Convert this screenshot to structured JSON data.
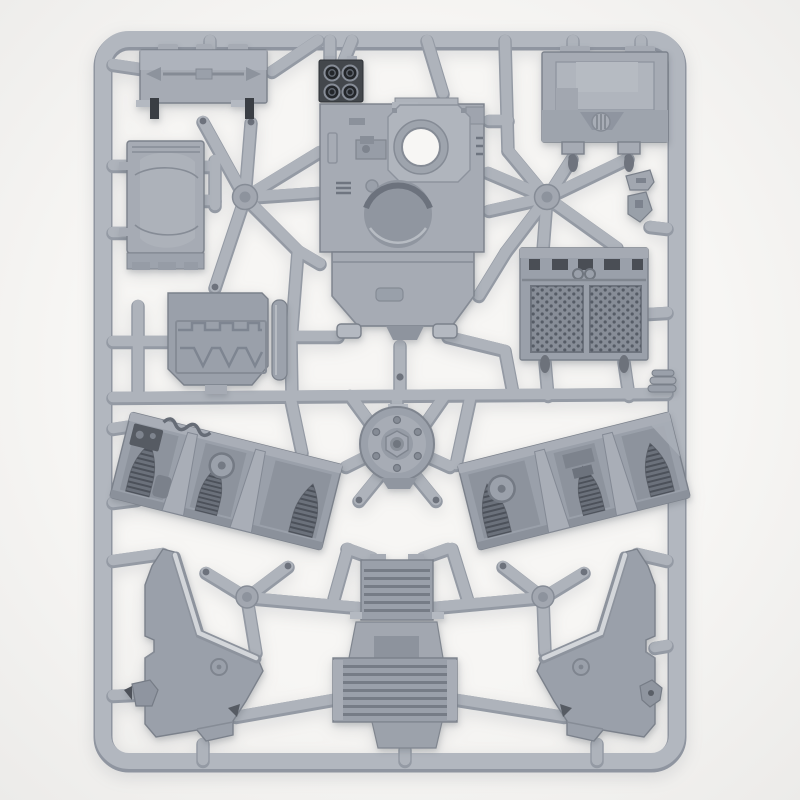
{
  "scene": {
    "subject": "grey plastic injection-moulded model kit sprue photographed on a white background",
    "frame": "rounded rectangular sprue frame with diagonal internal runners and four round junction bosses",
    "text_visible": "none"
  },
  "palette": {
    "background": "#f7f6f4",
    "background_edge": "#ecebe9",
    "frame": "#b2b7bf",
    "frame_shadow": "#8f95a0",
    "runner": "#aeb3bb",
    "runner_shadow": "#949aa4",
    "plastic_light": "#b4b9c1",
    "plastic_mid": "#a6abb4",
    "plastic_base": "#9aa0aa",
    "plastic_dark": "#8a9099",
    "recess": "#7c828d",
    "dark_detail": "#3a3e44",
    "mesh_dark": "#565c66",
    "highlight": "#d2d5d9",
    "hole_white": "#f7f6f4"
  },
  "parts": [
    {
      "name": "roof-hatch-panel",
      "desc": "long rectangular roof panel with hatch handle, top-left"
    },
    {
      "name": "floor-panel",
      "desc": "vertical rectangular floor panel with soft moulded curves, left"
    },
    {
      "name": "zigzag-armour-panel",
      "desc": "panel with embossed battlement zigzag, mid-left"
    },
    {
      "name": "hull-top-assembly",
      "desc": "large hull top with round turret-ring opening, quad-lens sensor block and recessed circle"
    },
    {
      "name": "top-right-access-panel",
      "desc": "rectangular access panel with ribbed dome vent"
    },
    {
      "name": "intake-grille-panel",
      "desc": "twin hex-mesh intake grille panel, mid-right"
    },
    {
      "name": "wheel-hub",
      "desc": "circular bolted hub in the centre"
    },
    {
      "name": "left-interior-tray",
      "desc": "angled interior tray with arched vents, hose and hatch"
    },
    {
      "name": "right-interior-tray",
      "desc": "mirrored angled interior tray"
    },
    {
      "name": "bottom-left-armour-plate",
      "desc": "large angular side armour plate with bevelled edge"
    },
    {
      "name": "bottom-right-armour-plate",
      "desc": "mirrored angular side armour plate"
    },
    {
      "name": "ramp-upper-section",
      "desc": "ribbed ramp upper plate, bottom centre"
    },
    {
      "name": "ramp-lower-section",
      "desc": "wide ribbed ramp lower plate with connector"
    },
    {
      "name": "small-bracket",
      "desc": "small bracket sprig right of hull"
    },
    {
      "name": "small-clip",
      "desc": "small angled clip right of hull"
    },
    {
      "name": "disc-stack",
      "desc": "stacked-disc part on right frame edge"
    },
    {
      "name": "left-hatch-cap",
      "desc": "small cap part on left frame edge"
    },
    {
      "name": "right-hatch-cap",
      "desc": "small cap part on right frame edge"
    }
  ]
}
